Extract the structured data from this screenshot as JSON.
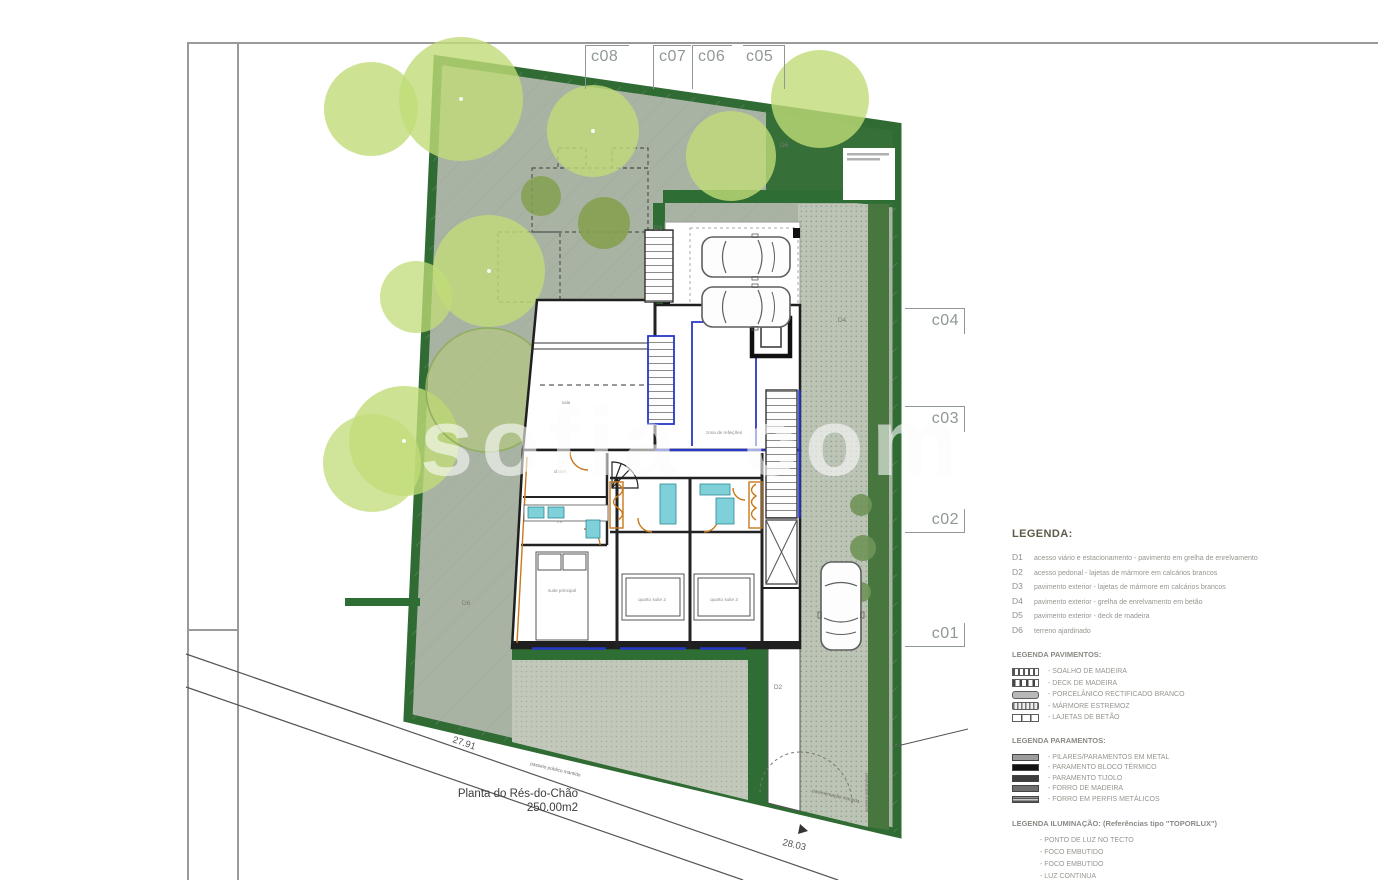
{
  "watermark": {
    "part1": "sofia",
    "part2": "com"
  },
  "markers": {
    "top": [
      "c08",
      "c07",
      "c06",
      "c05"
    ],
    "right": [
      "c04",
      "c03",
      "c02",
      "c01"
    ]
  },
  "title_block": {
    "name": "Planta do Rés-do-Chão",
    "area": "250.00m2"
  },
  "dims": {
    "left": "27.91",
    "bottom": "28.03"
  },
  "plan_labels": {
    "d2": "D2",
    "d3": "D3",
    "d4": "D4",
    "d6a": "D6",
    "d6b": "D6"
  },
  "street_notes": {
    "paving": "pavimentação mantida",
    "walk": "passeio público mantido",
    "access": "acesso automóvel"
  },
  "rooms": [
    {
      "name": "sala"
    },
    {
      "name": "zona de refeições"
    },
    {
      "name": "closet"
    },
    {
      "name": "i.s."
    },
    {
      "name": "suite principal"
    },
    {
      "name": "quarto suite 2"
    },
    {
      "name": "quarto suite 3"
    }
  ],
  "legend": {
    "title": "LEGENDA:",
    "items": [
      {
        "code": "D1",
        "text": "acesso viário e estacionamento - pavimento em grelha de enrelvamento"
      },
      {
        "code": "D2",
        "text": "acesso pedonal - lajetas de mármore em calcários brancos"
      },
      {
        "code": "D3",
        "text": "pavimento exterior - lajetas de mármore em calcários brancos"
      },
      {
        "code": "D4",
        "text": "pavimento exterior - grelha de enrelvamento em betão"
      },
      {
        "code": "D5",
        "text": "pavimento exterior - deck de madeira"
      },
      {
        "code": "D6",
        "text": "terreno ajardinado"
      }
    ]
  },
  "legend_pavimentos": {
    "title": "LEGENDA PAVIMENTOS:",
    "items": [
      {
        "swatch": "wood-strips",
        "text": "- SOALHO DE MADEIRA"
      },
      {
        "swatch": "deck-strips",
        "text": "- DECK DE MADEIRA"
      },
      {
        "swatch": "porcelain",
        "text": "- PORCELÂNICO RECTIFICADO BRANCO"
      },
      {
        "swatch": "marble",
        "text": "- MÁRMORE ESTREMOZ"
      },
      {
        "swatch": "concrete-slabs",
        "text": "- LAJETAS DE BETÃO"
      }
    ]
  },
  "legend_paramentos": {
    "title": "LEGENDA PARAMENTOS:",
    "items": [
      {
        "swatch": "metal",
        "text": "- PILARES/PARAMENTOS EM METAL"
      },
      {
        "swatch": "thermal-block",
        "text": "- PARAMENTO BLOCO TÉRMICO"
      },
      {
        "swatch": "brick",
        "text": "- PARAMENTO TIJOLO"
      },
      {
        "swatch": "wood-lining",
        "text": "- FORRO DE MADEIRA"
      },
      {
        "swatch": "metal-profiles",
        "text": "- FORRO EM PERFIS METÁLICOS"
      }
    ]
  },
  "legend_iluminacao": {
    "title": "LEGENDA ILUMINAÇÃO:  (Referências tipo \"TOPORLUX\")",
    "items": [
      "- PONTO DE LUZ NO TECTO",
      "- FOCO EMBUTIDO",
      "- FOCO EMBUTIDO",
      "- LUZ CONTINUA",
      "- PONTO DE LUZ NA PAREDE",
      "- PONTO DE LUZ NO PAVIMENTO",
      "- KIT (tomadas, tv, telefone)"
    ]
  },
  "colors": {
    "lawn": "#a9b3a4",
    "site_border_green": "#2f6b33",
    "tree_light": "#c1dc78",
    "tree_dark": "#85a050",
    "accent_blue": "#2737c8",
    "accent_orange": "#c8791c",
    "fixture_cyan": "#7fd0d8"
  }
}
